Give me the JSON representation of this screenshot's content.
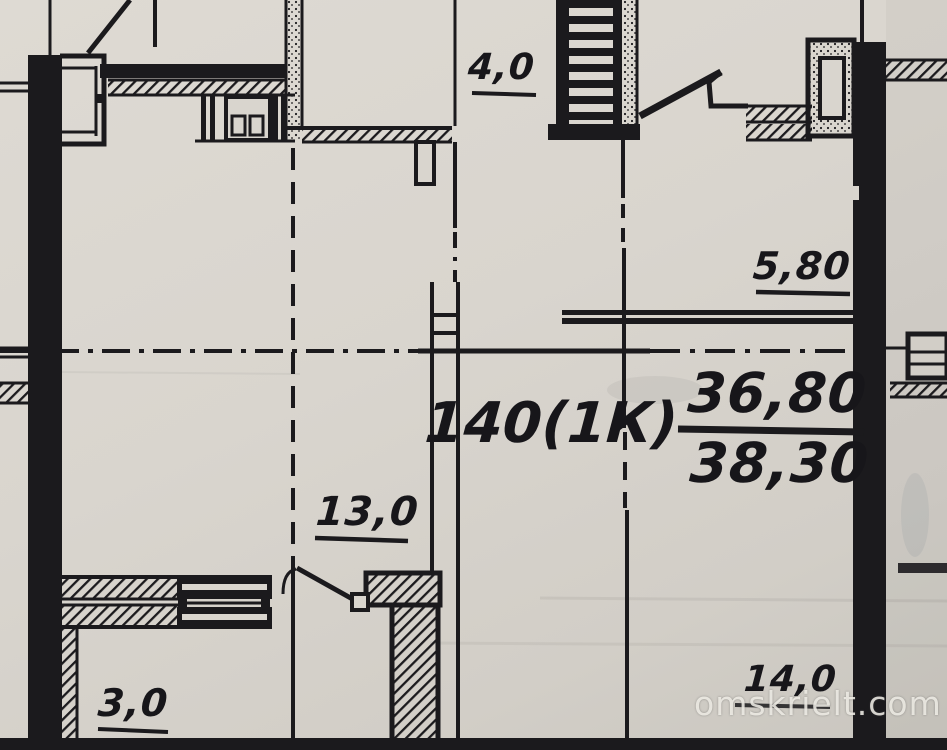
{
  "plan": {
    "dimensions": {
      "top_corridor": "4,0",
      "loggia_glazing": "5,80",
      "kitchen": "13,0",
      "balcony": "3,0",
      "room": "14,0"
    },
    "apartment": {
      "number_label": "140(1К)",
      "area_living": "36,80",
      "area_total": "38,30"
    }
  },
  "watermark": {
    "text": "omskrielt.com"
  },
  "colors": {
    "paper": "#d9d5ce",
    "ink": "#1b1a1d",
    "watermark": "#f3f1ea"
  }
}
